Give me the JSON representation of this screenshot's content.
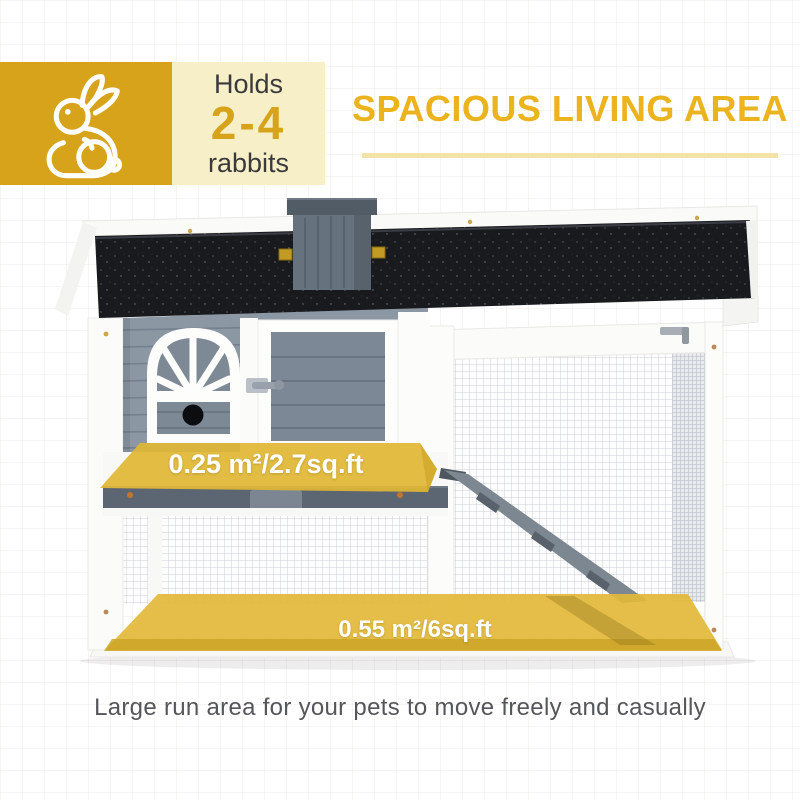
{
  "capacity_badge": {
    "icon": "rabbit-icon",
    "line1": "Holds",
    "count": "2-4",
    "line3": "rabbits"
  },
  "heading": {
    "title": "SPACIOUS LIVING AREA"
  },
  "figure": {
    "hutch_area_label": "0.25 m²/2.7sq.ft",
    "run_area_label": "0.55 m²/6sq.ft"
  },
  "caption": {
    "text": "Large run area for your pets to move freely and casually"
  },
  "colors": {
    "accent_gold": "#D7A31B",
    "pale_gold_panel": "#F7EFC7",
    "heading_gold": "#EBB31D",
    "underline_gold": "#F4E3A6",
    "highlight_overlay": "#E2B838",
    "roof_black": "#191A1E",
    "wall_gray": "#8C97A4",
    "dark_text": "#3A3A3C",
    "caption_gray": "#55565A"
  }
}
